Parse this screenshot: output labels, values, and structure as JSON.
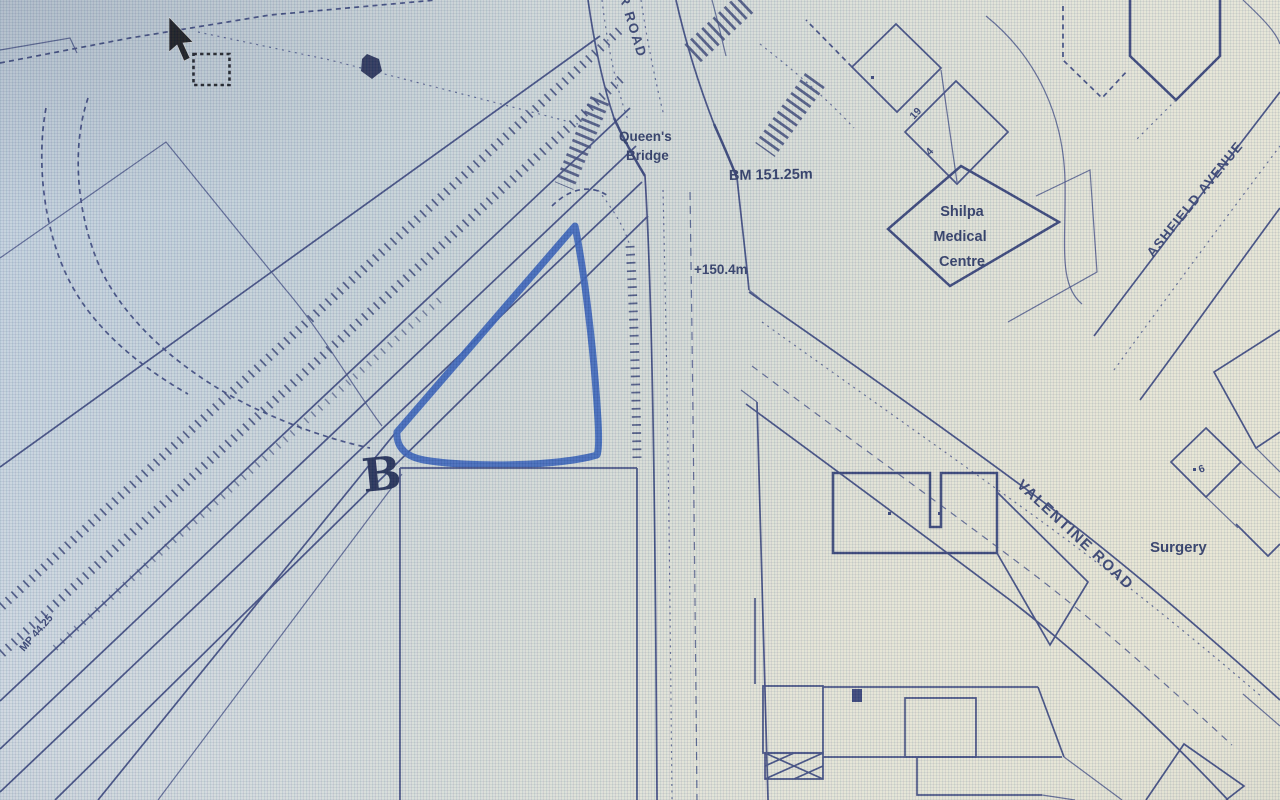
{
  "map": {
    "road_labels": {
      "top_road": "ER ROAD",
      "ashfield_avenue": "ASHFIELD AVENUE",
      "valentine_road": "VALENTINE ROAD"
    },
    "place_labels": {
      "queens_bridge_line1": "Queen's",
      "queens_bridge_line2": "Bridge",
      "medical_centre_line1": "Shilpa",
      "medical_centre_line2": "Medical",
      "medical_centre_line3": "Centre",
      "surgery": "Surgery"
    },
    "survey_marks": {
      "bench_mark": "BM 151.25m",
      "spot_height": "+150.4m",
      "mile_post": "MP 44.25"
    },
    "house_numbers": {
      "plot_19": "19",
      "plot_4": "4",
      "plot_6": "6"
    },
    "annotation": {
      "site_letter": "B"
    },
    "icons": {
      "cursor": "arrow-pointer-icon",
      "selection": "dashed-selection-box"
    },
    "colors": {
      "map_ink": "#36427a",
      "label_ink": "#25315f",
      "site_outline_blue": "#2b57b5",
      "paper_tint_left": "#cbd6e1",
      "paper_tint_right": "#e6e5d5"
    }
  }
}
